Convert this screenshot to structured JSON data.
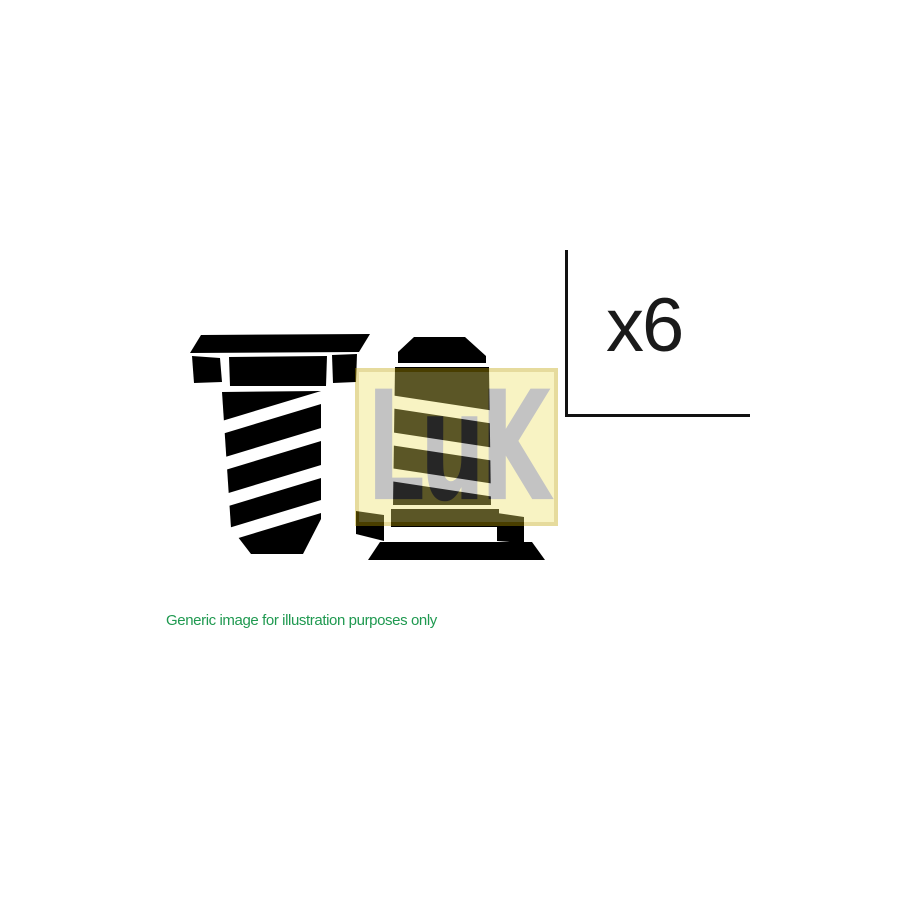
{
  "canvas": {
    "width": 900,
    "height": 900,
    "background_color": "#ffffff"
  },
  "illustration": {
    "description": "Two black hex-head bolt silhouettes with striped threaded shanks",
    "ink_color": "#000000",
    "parts": [
      {
        "name": "hex-head-bolt-left-head-up"
      },
      {
        "name": "hex-head-bolt-right-inverted-tip-up"
      }
    ]
  },
  "brand_logo": {
    "text": "LuK",
    "background_color": "#efe264",
    "letter_color": "#646464",
    "border_color": "#bfa300",
    "overlay_opacity": 0.38
  },
  "quantity": {
    "label": "x6"
  },
  "disclaimer": {
    "text": "Generic image for illustration purposes only",
    "color": "#1f9950"
  }
}
